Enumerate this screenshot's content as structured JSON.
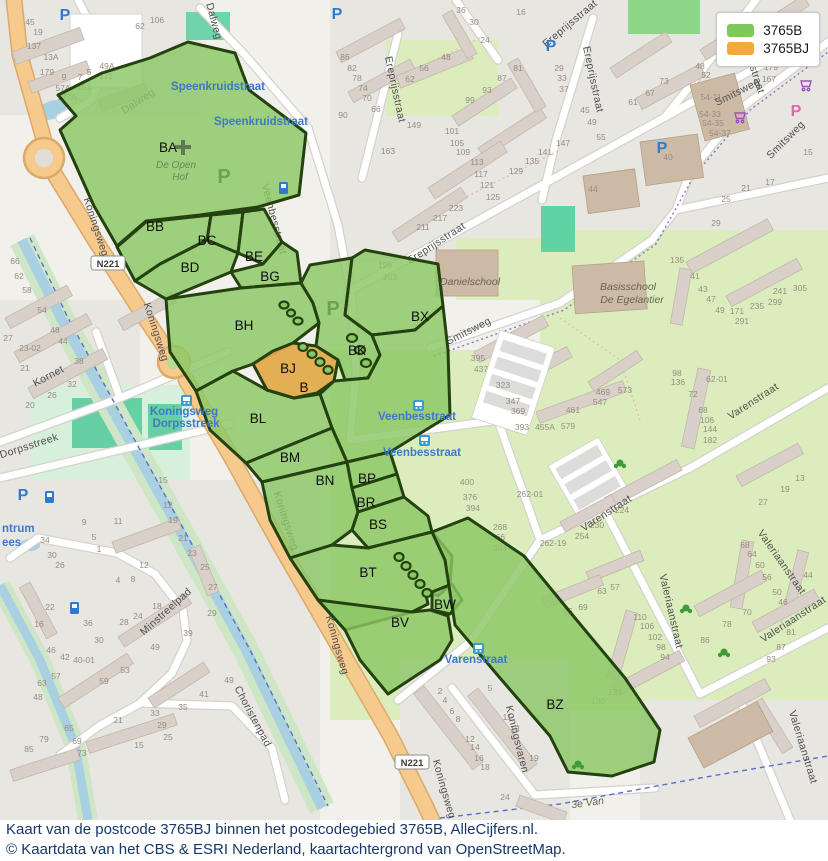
{
  "legend": {
    "items": [
      {
        "label": "3765B",
        "color": "#7fc85c"
      },
      {
        "label": "3765BJ",
        "color": "#f5a93c"
      }
    ]
  },
  "caption": {
    "line1": "Kaart van de postcode 3765BJ binnen het postcodegebied 3765B, AlleCijfers.nl.",
    "line2": "© Kaartdata van het CBS & ESRI Nederland, kaartachtergrond van OpenStreetMap."
  },
  "highlighted_region": "BJ",
  "regions": [
    [
      "BA",
      168,
      152
    ],
    [
      "BB",
      155,
      231
    ],
    [
      "BC",
      207,
      245
    ],
    [
      "BD",
      190,
      272
    ],
    [
      "BE",
      254,
      261
    ],
    [
      "BG",
      270,
      281
    ],
    [
      "BH",
      244,
      330
    ],
    [
      "BJ",
      288,
      373
    ],
    [
      "B",
      304,
      392
    ],
    [
      "BK",
      357,
      355
    ],
    [
      "BX",
      420,
      321
    ],
    [
      "BL",
      258,
      423
    ],
    [
      "BM",
      290,
      462
    ],
    [
      "BN",
      325,
      485
    ],
    [
      "BP",
      367,
      483
    ],
    [
      "BR",
      366,
      507
    ],
    [
      "BS",
      378,
      529
    ],
    [
      "BT",
      368,
      577
    ],
    [
      "BV",
      400,
      627
    ],
    [
      "BW",
      445,
      609
    ],
    [
      "BZ",
      555,
      709
    ]
  ],
  "map_labels": {
    "streets": [
      [
        "Dalweg",
        140,
        104,
        -33
      ],
      [
        "Dalweg",
        211,
        22,
        75
      ],
      [
        "Koningsweg",
        93,
        228,
        72
      ],
      [
        "Koningsweg",
        153,
        333,
        72
      ],
      [
        "Koningsweg",
        283,
        522,
        72
      ],
      [
        "Koningsweg",
        334,
        646,
        74
      ],
      [
        "Koningsweg",
        441,
        790,
        74
      ],
      [
        "Kornet",
        50,
        379,
        -28
      ],
      [
        "Dorpsstreek",
        30,
        449,
        -18
      ],
      [
        "Minstreelpad",
        168,
        614,
        -42
      ],
      [
        "Choristenpad",
        250,
        718,
        62
      ],
      [
        "Koningsvaren",
        514,
        740,
        76
      ],
      [
        "Smitsweg",
        470,
        334,
        -27
      ],
      [
        "Smitsweg",
        739,
        95,
        -27
      ],
      [
        "Smitsweg",
        788,
        142,
        -45
      ],
      [
        "Ereprijsstraat",
        392,
        90,
        78
      ],
      [
        "Ereprijsstraat",
        438,
        246,
        -33
      ],
      [
        "Ereprijsstraat",
        590,
        80,
        78
      ],
      [
        "Ereprijsstraat",
        572,
        26,
        -40
      ],
      [
        "Ereprijsstraat",
        748,
        62,
        72
      ],
      [
        "Veenbesstraat",
        271,
        220,
        75
      ],
      [
        "Varenstraat",
        608,
        516,
        -33
      ],
      [
        "Varenstraat",
        755,
        404,
        -33
      ],
      [
        "Valeriaanstraat",
        668,
        612,
        77
      ],
      [
        "Valeriaanstraat",
        779,
        564,
        55
      ],
      [
        "Valeriaanstraat",
        795,
        622,
        -33
      ],
      [
        "Valeriaanstraat",
        800,
        748,
        73
      ]
    ],
    "bus_stops": [
      [
        "Speenkruidstraat",
        218,
        90
      ],
      [
        "Speenkruidstraat",
        261,
        125
      ],
      [
        "Veenbesstraat",
        417,
        420
      ],
      [
        "Veenbesstraat",
        422,
        456
      ],
      [
        "Koningsweg",
        184,
        415
      ],
      [
        "Dorpsstreek",
        186,
        427
      ],
      [
        "Varenstraat",
        476,
        663
      ]
    ],
    "fragments": [
      [
        "ntrum",
        2,
        532
      ],
      [
        "ees",
        2,
        546
      ]
    ],
    "poi": [
      [
        "Danielschool",
        470,
        285,
        0,
        "school"
      ],
      [
        "Basisschool",
        628,
        290,
        0,
        "school"
      ],
      [
        "De Egelantier",
        632,
        303,
        0,
        "school"
      ],
      [
        "3e Van",
        588,
        806,
        -8,
        "school"
      ],
      [
        "De Open",
        176,
        168,
        0,
        "ghostname"
      ],
      [
        "Hof",
        180,
        180,
        0,
        "ghostname"
      ],
      [
        "P",
        224,
        183,
        0,
        "ghostP"
      ],
      [
        "P",
        333,
        315,
        0,
        "ghostP"
      ],
      [
        "P",
        65,
        20,
        0,
        "blueP"
      ],
      [
        "P",
        337,
        19,
        0,
        "blueP"
      ],
      [
        "P",
        551,
        51,
        0,
        "blueP"
      ],
      [
        "P",
        662,
        153,
        0,
        "blueP"
      ],
      [
        "P",
        23,
        500,
        0,
        "blueP"
      ],
      [
        "P",
        796,
        116,
        0,
        "pinkP"
      ]
    ],
    "shields": [
      [
        "N221",
        108,
        266
      ],
      [
        "N221",
        412,
        765
      ]
    ],
    "house_numbers": [
      [
        "45",
        30,
        25
      ],
      [
        "19",
        38,
        35
      ],
      [
        "137",
        34,
        49
      ],
      [
        "13A",
        51,
        60
      ],
      [
        "179",
        47,
        75
      ],
      [
        "9",
        64,
        80
      ],
      [
        "7",
        80,
        80
      ],
      [
        "5",
        89,
        75
      ],
      [
        "49A",
        107,
        69
      ],
      [
        "171",
        106,
        79
      ],
      [
        "57A",
        63,
        91
      ],
      [
        "151",
        84,
        90
      ],
      [
        "177A",
        67,
        100
      ],
      [
        "62",
        140,
        29
      ],
      [
        "106",
        157,
        23
      ],
      [
        "66",
        15,
        264
      ],
      [
        "62",
        19,
        279
      ],
      [
        "58",
        27,
        293
      ],
      [
        "54",
        42,
        313
      ],
      [
        "48",
        55,
        333
      ],
      [
        "44",
        63,
        344
      ],
      [
        "38",
        79,
        364
      ],
      [
        "32",
        72,
        387
      ],
      [
        "26",
        52,
        398
      ],
      [
        "27",
        8,
        341
      ],
      [
        "23-02",
        30,
        351
      ],
      [
        "21",
        25,
        371
      ],
      [
        "20",
        30,
        408
      ],
      [
        "15",
        163,
        483
      ],
      [
        "12",
        168,
        508
      ],
      [
        "19",
        173,
        523
      ],
      [
        "9",
        84,
        525
      ],
      [
        "11",
        118,
        524
      ],
      [
        "36",
        461,
        13
      ],
      [
        "30",
        474,
        25
      ],
      [
        "24",
        485,
        43
      ],
      [
        "48",
        446,
        60
      ],
      [
        "56",
        424,
        71
      ],
      [
        "62",
        410,
        82
      ],
      [
        "86",
        345,
        60
      ],
      [
        "82",
        352,
        71
      ],
      [
        "78",
        357,
        81
      ],
      [
        "74",
        363,
        91
      ],
      [
        "70",
        367,
        101
      ],
      [
        "66",
        376,
        112
      ],
      [
        "90",
        343,
        118
      ],
      [
        "149",
        414,
        128
      ],
      [
        "163",
        388,
        154
      ],
      [
        "101",
        452,
        134
      ],
      [
        "105",
        457,
        146
      ],
      [
        "109",
        463,
        155
      ],
      [
        "113",
        477,
        165
      ],
      [
        "117",
        481,
        177
      ],
      [
        "121",
        487,
        188
      ],
      [
        "125",
        493,
        200
      ],
      [
        "129",
        516,
        174
      ],
      [
        "135",
        532,
        164
      ],
      [
        "141",
        545,
        155
      ],
      [
        "147",
        563,
        146
      ],
      [
        "223",
        456,
        211
      ],
      [
        "217",
        440,
        221
      ],
      [
        "211",
        423,
        230
      ],
      [
        "199",
        385,
        268
      ],
      [
        "203",
        390,
        280
      ],
      [
        "16",
        521,
        15
      ],
      [
        "29",
        559,
        71
      ],
      [
        "33",
        562,
        81
      ],
      [
        "37",
        564,
        92
      ],
      [
        "99",
        470,
        103
      ],
      [
        "93",
        487,
        93
      ],
      [
        "87",
        502,
        81
      ],
      [
        "81",
        518,
        71
      ],
      [
        "48",
        700,
        69
      ],
      [
        "52",
        706,
        78
      ],
      [
        "54-11",
        711,
        100
      ],
      [
        "54-33",
        710,
        117
      ],
      [
        "54-35",
        713,
        126
      ],
      [
        "54-37",
        720,
        136
      ],
      [
        "73",
        664,
        84
      ],
      [
        "67",
        650,
        96
      ],
      [
        "61",
        633,
        105
      ],
      [
        "55",
        601,
        140
      ],
      [
        "49",
        592,
        125
      ],
      [
        "45",
        585,
        113
      ],
      [
        "179",
        771,
        70
      ],
      [
        "167",
        769,
        82
      ],
      [
        "40",
        668,
        160
      ],
      [
        "44",
        593,
        192
      ],
      [
        "15",
        808,
        155
      ],
      [
        "17",
        770,
        185
      ],
      [
        "21",
        746,
        191
      ],
      [
        "25",
        726,
        202
      ],
      [
        "29",
        716,
        226
      ],
      [
        "395",
        478,
        361
      ],
      [
        "437",
        481,
        372
      ],
      [
        "323",
        503,
        388
      ],
      [
        "347",
        513,
        404
      ],
      [
        "369",
        518,
        414
      ],
      [
        "393",
        522,
        430
      ],
      [
        "455A",
        545,
        430
      ],
      [
        "579",
        568,
        429
      ],
      [
        "461",
        573,
        413
      ],
      [
        "469",
        603,
        395
      ],
      [
        "573",
        625,
        393
      ],
      [
        "547",
        600,
        405
      ],
      [
        "135",
        677,
        263
      ],
      [
        "41",
        695,
        279
      ],
      [
        "43",
        703,
        292
      ],
      [
        "47",
        711,
        302
      ],
      [
        "49",
        720,
        313
      ],
      [
        "171",
        737,
        314
      ],
      [
        "235",
        757,
        309
      ],
      [
        "299",
        775,
        305
      ],
      [
        "241",
        780,
        294
      ],
      [
        "305",
        800,
        291
      ],
      [
        "291",
        742,
        324
      ],
      [
        "98",
        677,
        376
      ],
      [
        "136",
        678,
        385
      ],
      [
        "72",
        693,
        397
      ],
      [
        "68",
        703,
        413
      ],
      [
        "106",
        707,
        423
      ],
      [
        "144",
        710,
        432
      ],
      [
        "182",
        710,
        443
      ],
      [
        "62-01",
        717,
        382
      ],
      [
        "262-01",
        530,
        497
      ],
      [
        "400",
        467,
        485
      ],
      [
        "376",
        470,
        500
      ],
      [
        "394",
        473,
        511
      ],
      [
        "268",
        500,
        530
      ],
      [
        "366",
        498,
        540
      ],
      [
        "384",
        500,
        551
      ],
      [
        "262-19",
        553,
        546
      ],
      [
        "224",
        622,
        513
      ],
      [
        "230",
        597,
        528
      ],
      [
        "254",
        582,
        539
      ],
      [
        "27",
        763,
        505
      ],
      [
        "19",
        785,
        492
      ],
      [
        "13",
        800,
        481
      ],
      [
        "68",
        745,
        548
      ],
      [
        "64",
        752,
        557
      ],
      [
        "60",
        760,
        568
      ],
      [
        "56",
        767,
        580
      ],
      [
        "50",
        777,
        595
      ],
      [
        "46",
        783,
        605
      ],
      [
        "44",
        808,
        578
      ],
      [
        "63",
        602,
        594
      ],
      [
        "57",
        615,
        590
      ],
      [
        "75",
        568,
        614
      ],
      [
        "69",
        583,
        610
      ],
      [
        "110",
        640,
        620
      ],
      [
        "106",
        647,
        629
      ],
      [
        "102",
        655,
        640
      ],
      [
        "98",
        661,
        650
      ],
      [
        "94",
        665,
        660
      ],
      [
        "70",
        747,
        615
      ],
      [
        "78",
        727,
        627
      ],
      [
        "86",
        705,
        643
      ],
      [
        "81",
        791,
        635
      ],
      [
        "87",
        781,
        650
      ],
      [
        "93",
        771,
        662
      ],
      [
        "2",
        440,
        694
      ],
      [
        "4",
        445,
        703
      ],
      [
        "6",
        452,
        714
      ],
      [
        "8",
        458,
        722
      ],
      [
        "12",
        470,
        742
      ],
      [
        "14",
        475,
        750
      ],
      [
        "16",
        479,
        761
      ],
      [
        "18",
        485,
        770
      ],
      [
        "24",
        505,
        800
      ],
      [
        "5",
        490,
        691
      ],
      [
        "11",
        507,
        720
      ],
      [
        "13",
        515,
        732
      ],
      [
        "19",
        534,
        761
      ],
      [
        "124",
        615,
        695
      ],
      [
        "130",
        598,
        704
      ],
      [
        "34",
        45,
        543
      ],
      [
        "30",
        52,
        558
      ],
      [
        "26",
        60,
        568
      ],
      [
        "5",
        94,
        540
      ],
      [
        "1",
        99,
        552
      ],
      [
        "21",
        183,
        541
      ],
      [
        "23",
        192,
        556
      ],
      [
        "25",
        205,
        570
      ],
      [
        "27",
        213,
        590
      ],
      [
        "12",
        144,
        568
      ],
      [
        "8",
        133,
        582
      ],
      [
        "4",
        118,
        583
      ],
      [
        "18",
        157,
        609
      ],
      [
        "24",
        138,
        619
      ],
      [
        "28",
        124,
        625
      ],
      [
        "36",
        88,
        626
      ],
      [
        "30",
        99,
        643
      ],
      [
        "22",
        50,
        610
      ],
      [
        "16",
        39,
        627
      ],
      [
        "46",
        51,
        653
      ],
      [
        "42",
        65,
        660
      ],
      [
        "40-01",
        84,
        663
      ],
      [
        "29",
        212,
        616
      ],
      [
        "39",
        188,
        636
      ],
      [
        "49",
        155,
        650
      ],
      [
        "53",
        125,
        673
      ],
      [
        "59",
        104,
        684
      ],
      [
        "48",
        38,
        700
      ],
      [
        "33",
        155,
        716
      ],
      [
        "35",
        183,
        710
      ],
      [
        "41",
        204,
        697
      ],
      [
        "29",
        162,
        728
      ],
      [
        "25",
        168,
        740
      ],
      [
        "21",
        118,
        723
      ],
      [
        "15",
        139,
        748
      ],
      [
        "65",
        69,
        731
      ],
      [
        "69",
        77,
        744
      ],
      [
        "73",
        82,
        756
      ],
      [
        "79",
        44,
        742
      ],
      [
        "85",
        29,
        752
      ],
      [
        "57",
        56,
        679
      ],
      [
        "63",
        42,
        686
      ],
      [
        "49",
        229,
        683
      ]
    ]
  }
}
